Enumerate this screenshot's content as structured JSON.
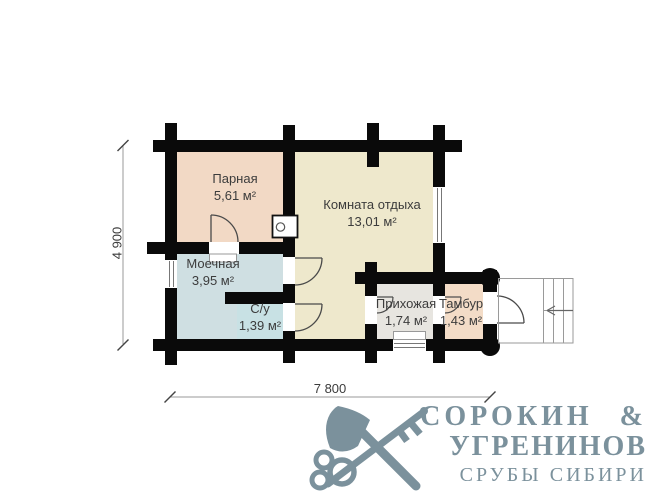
{
  "rooms": [
    {
      "name": "Парная",
      "area": "5,61 м²"
    },
    {
      "name": "Комната отдыха",
      "area": "13,01 м²"
    },
    {
      "name": "Моечная",
      "area": "3,95 м²"
    },
    {
      "name": "С/у",
      "area": "1,39 м²"
    },
    {
      "name": "Прихожая",
      "area": "1,74 м²"
    },
    {
      "name": "Тамбур",
      "area": "1,43 м²"
    }
  ],
  "dimensions": {
    "width": "7 800",
    "height": "4 900"
  },
  "logo": {
    "line1": "СОРОКИН &",
    "line2": "УГРЕНИНОВ",
    "line3": "СРУБЫ СИБИРИ"
  },
  "colors": {
    "wall": "#0a0a0a",
    "parnaya": "#f2d9c5",
    "komnata_otdyha": "#eee8cc",
    "moechnaya": "#cfdfe2",
    "su": "#c8e1e4",
    "prihozhaya": "#e7e5e0",
    "tambur": "#f3dcc7",
    "logo_accent": "#7b919c",
    "dim_line": "#999999"
  }
}
